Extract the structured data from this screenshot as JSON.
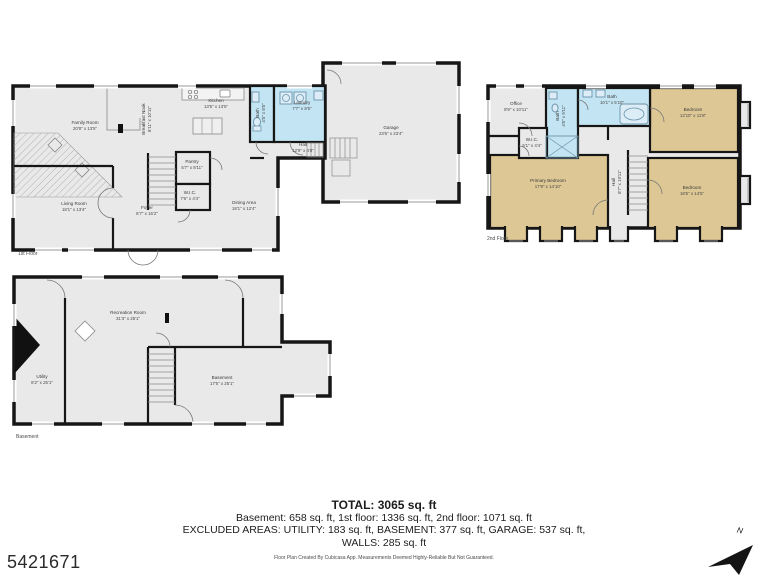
{
  "floors": [
    {
      "label": "1st Floor",
      "rooms": [
        {
          "name": "Family Room",
          "dims": "20'8\" x 13'5\""
        },
        {
          "name": "Breakfast Nook",
          "dims": "8'11\" x 10'11\""
        },
        {
          "name": "Kitchen",
          "dims": "13'5\" x 13'5\""
        },
        {
          "name": "Bath",
          "dims": "4'5\" x 8'5\""
        },
        {
          "name": "Laundry",
          "dims": "7'7\" x 8'5\""
        },
        {
          "name": "Hall",
          "dims": "12'9\" x 4'8\""
        },
        {
          "name": "Pantry",
          "dims": "5'7\" x 8'11\""
        },
        {
          "name": "W.I.C.",
          "dims": "7'6\" x 4'4\""
        },
        {
          "name": "Foyer",
          "dims": "8'7\" x 16'2\""
        },
        {
          "name": "Living Room",
          "dims": "18'1\" x 13'4\""
        },
        {
          "name": "Dining Area",
          "dims": "18'1\" x 12'4\""
        },
        {
          "name": "Garage",
          "dims": "23'6\" x 23'4\""
        }
      ]
    },
    {
      "label": "2nd Floor",
      "rooms": [
        {
          "name": "Office",
          "dims": "8'9\" x 10'11\""
        },
        {
          "name": "Bath",
          "dims": "4'5\" x 9'11\""
        },
        {
          "name": "Bath",
          "dims": "10'1\" x 5'10\""
        },
        {
          "name": "W.I.C.",
          "dims": "5'1\" x 4'4\""
        },
        {
          "name": "Bedroom",
          "dims": "12'10\" x 11'8\""
        },
        {
          "name": "Primary Bedroom",
          "dims": "17'9\" x 14'10\""
        },
        {
          "name": "Hall",
          "dims": "8'7\" x 19'11\""
        },
        {
          "name": "Bedroom",
          "dims": "18'5\" x 14'5\""
        }
      ]
    },
    {
      "label": "Basement",
      "rooms": [
        {
          "name": "Recreation Room",
          "dims": "31'3\" x 25'1\""
        },
        {
          "name": "Utility",
          "dims": "8'2\" x 25'1\""
        },
        {
          "name": "Basement",
          "dims": "17'5\" x 25'1\""
        }
      ]
    }
  ],
  "summary": {
    "total": "TOTAL: 3065 sq. ft",
    "floors_line": "Basement: 658 sq. ft, 1st floor: 1336 sq. ft, 2nd floor: 1071 sq. ft",
    "excluded_line": "EXCLUDED AREAS: UTILITY: 183 sq. ft, BASEMENT: 377 sq. ft, GARAGE: 537 sq. ft,",
    "walls_line": "WALLS: 285 sq. ft",
    "disclaimer": "Floor Plan Created By Cubicasa App. Measurements Deemed Highly-Reliable But Not Guaranteed."
  },
  "mls_number": "5421671",
  "compass": {
    "label": "N"
  },
  "colors": {
    "floor": "#e9e9e9",
    "wall": "#161616",
    "wet_room": "#c3e5f3",
    "bedroom": "#dcc795"
  }
}
